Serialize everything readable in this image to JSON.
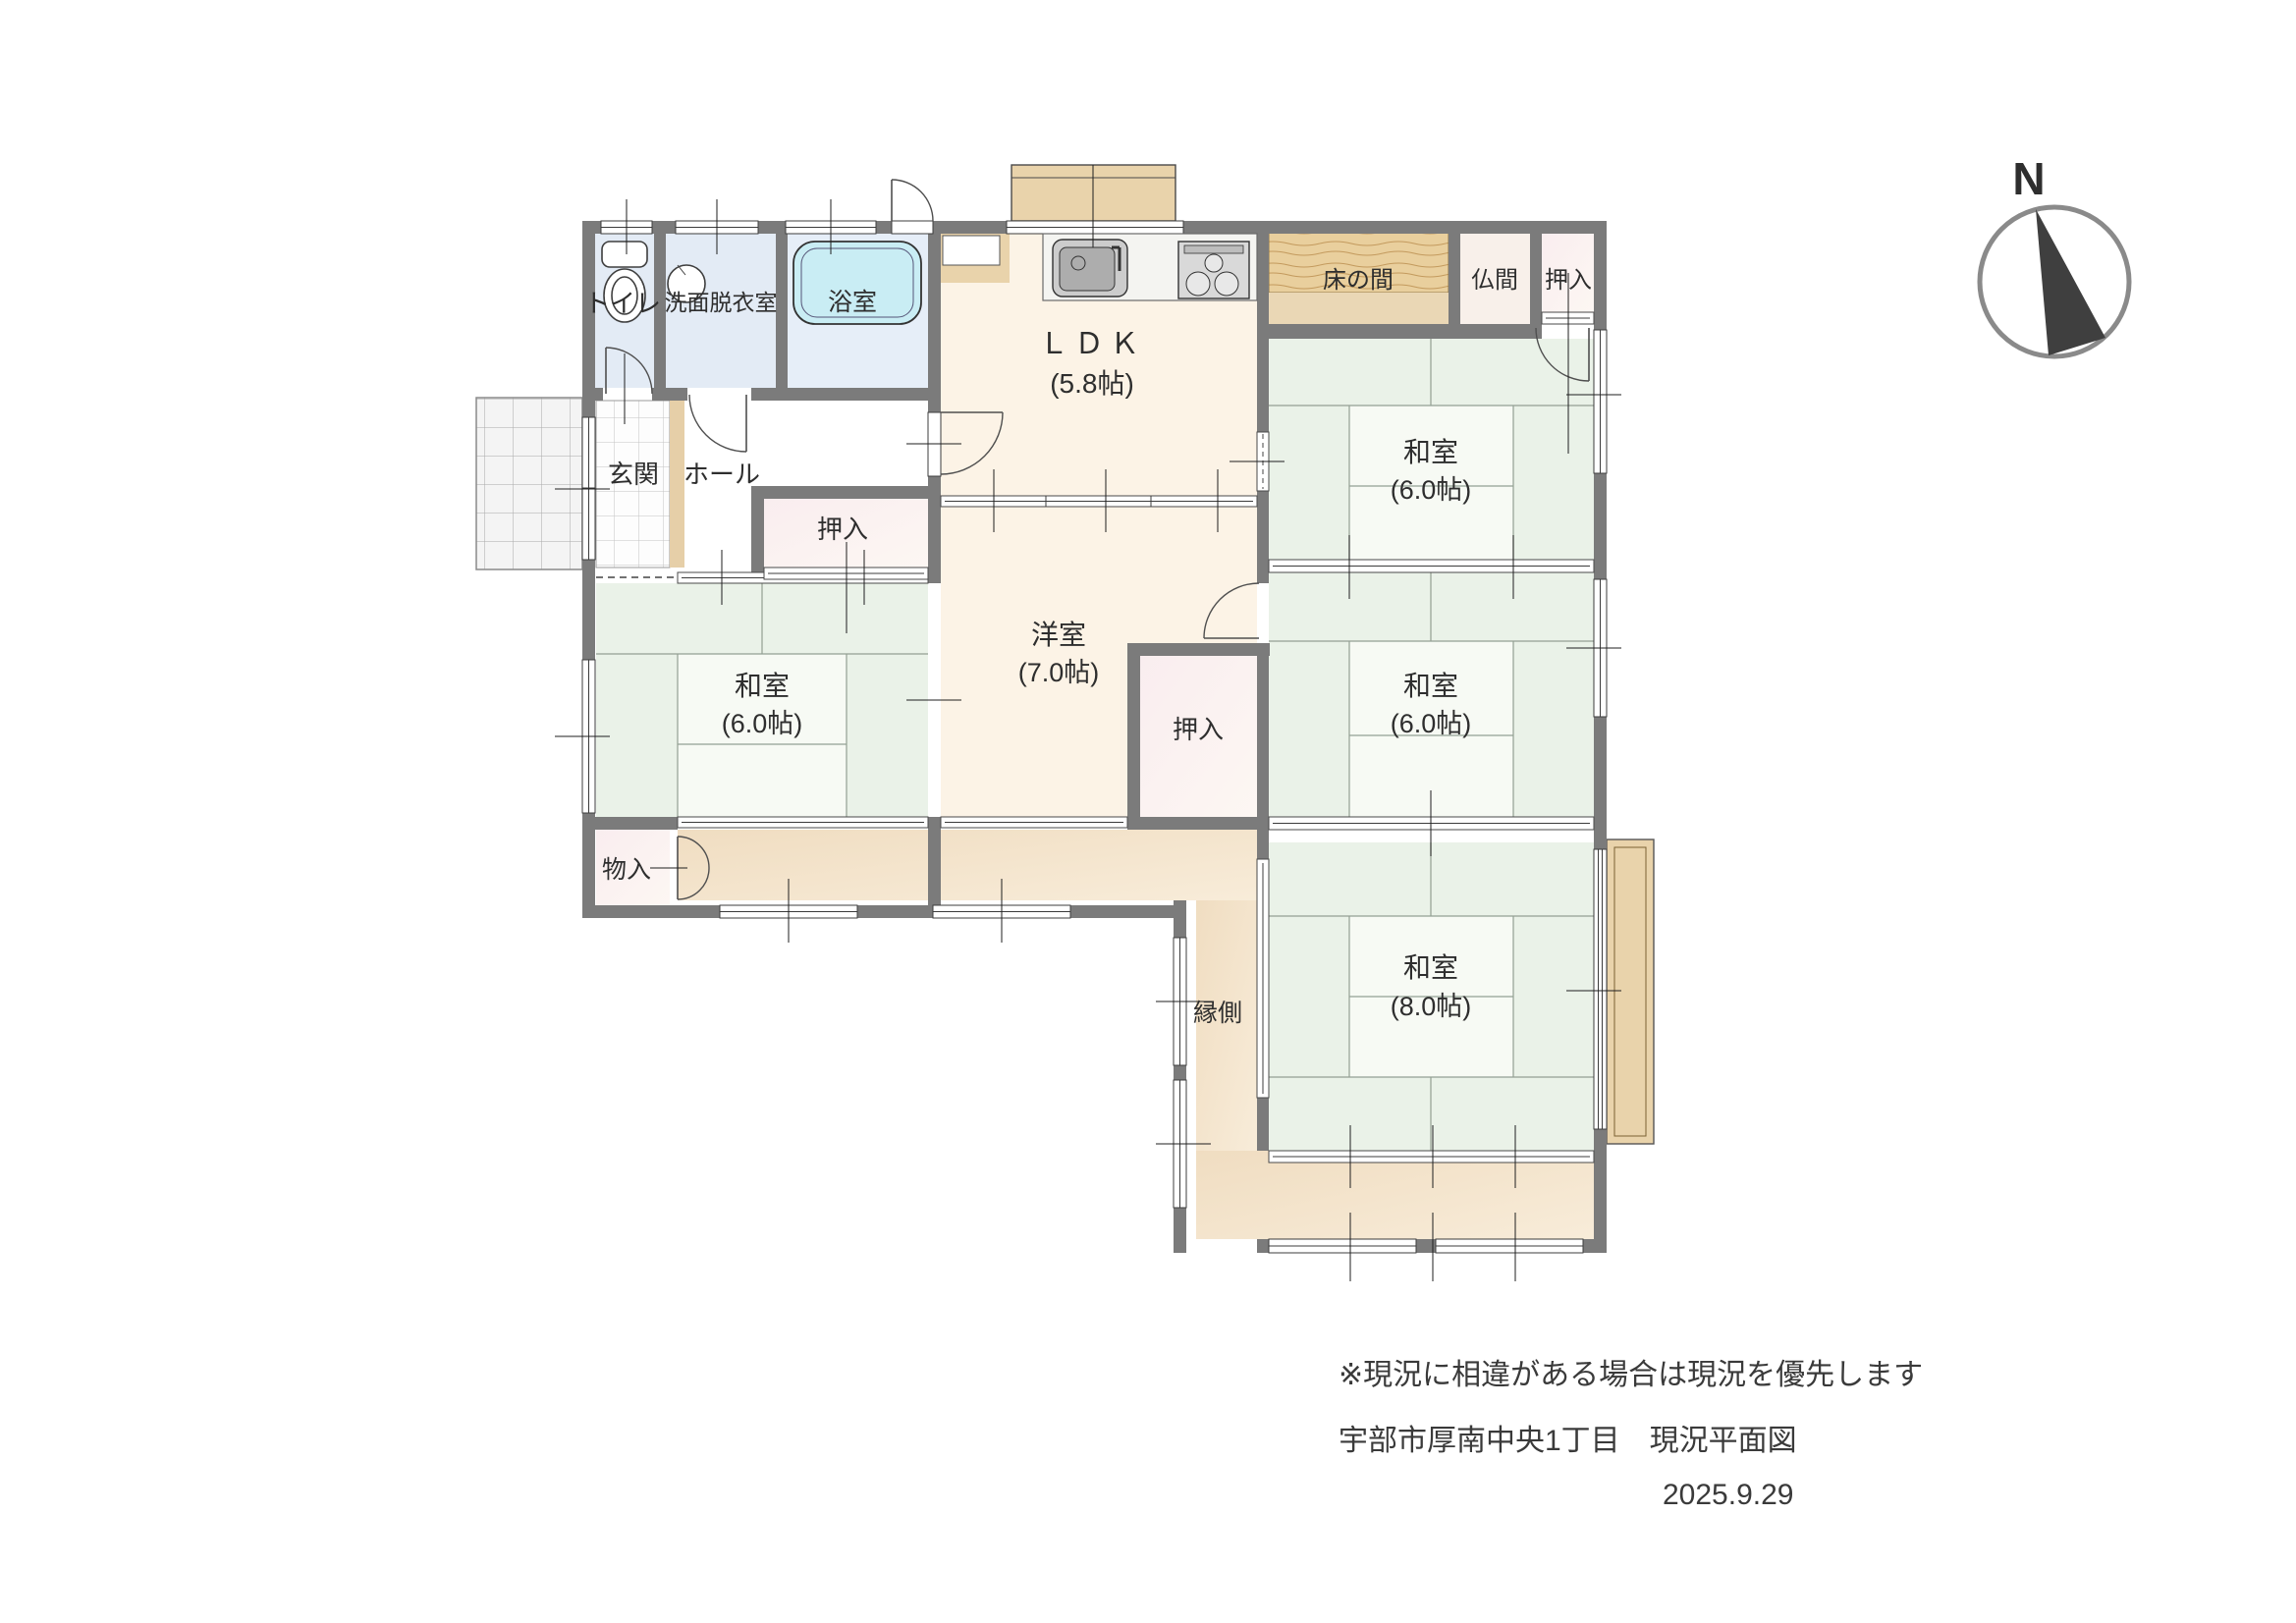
{
  "document": {
    "type": "floor-plan",
    "notes": {
      "disclaimer": "※現況に相違がある場合は現況を優先します",
      "address_title": "宇部市厚南中央1丁目　現況平面図",
      "date": "2025.9.29"
    },
    "compass": {
      "label": "N"
    }
  },
  "rooms": {
    "toilet": {
      "name": "トイレ"
    },
    "washroom": {
      "name": "洗面脱衣室"
    },
    "bath": {
      "name": "浴室"
    },
    "ldk": {
      "name": "ＬＤＫ",
      "size": "(5.8帖)"
    },
    "tokonoma": {
      "name": "床の間"
    },
    "butsuma": {
      "name": "仏間"
    },
    "oshiire_ne": {
      "name": "押入"
    },
    "washitsu_ne": {
      "name": "和室",
      "size": "(6.0帖)"
    },
    "genkan": {
      "name": "玄関"
    },
    "hall": {
      "name": "ホール"
    },
    "oshiire_hall": {
      "name": "押入"
    },
    "washitsu_sw": {
      "name": "和室",
      "size": "(6.0帖)"
    },
    "yoshitsu": {
      "name": "洋室",
      "size": "(7.0帖)"
    },
    "oshiire_mid": {
      "name": "押入"
    },
    "washitsu_e": {
      "name": "和室",
      "size": "(6.0帖)"
    },
    "monoire": {
      "name": "物入"
    },
    "engawa": {
      "name": "縁側"
    },
    "washitsu_s": {
      "name": "和室",
      "size": "(8.0帖)"
    }
  },
  "fixtures": {
    "toilet_bowl": "western-toilet-icon",
    "washbasin": "round-basin-icon",
    "bathtub": "bathtub-icon",
    "kitchen_sink": "kitchen-sink-icon",
    "stove": "three-burner-stove-icon"
  },
  "colors": {
    "wall": "#7b7b7b",
    "tatami": "#eaf2e8",
    "tatami_center": "#f7faf4",
    "wood_floor_cream": "#fcf3e6",
    "wet_room_blue": "#e3ebf5",
    "bathtub_cyan": "#c9edf4",
    "closet_pink": "#faeff1",
    "tokonoma_wood": "#e9cf9d",
    "corridor_tan": "#f2e2c9",
    "deck_tan": "#e9d3ab"
  }
}
